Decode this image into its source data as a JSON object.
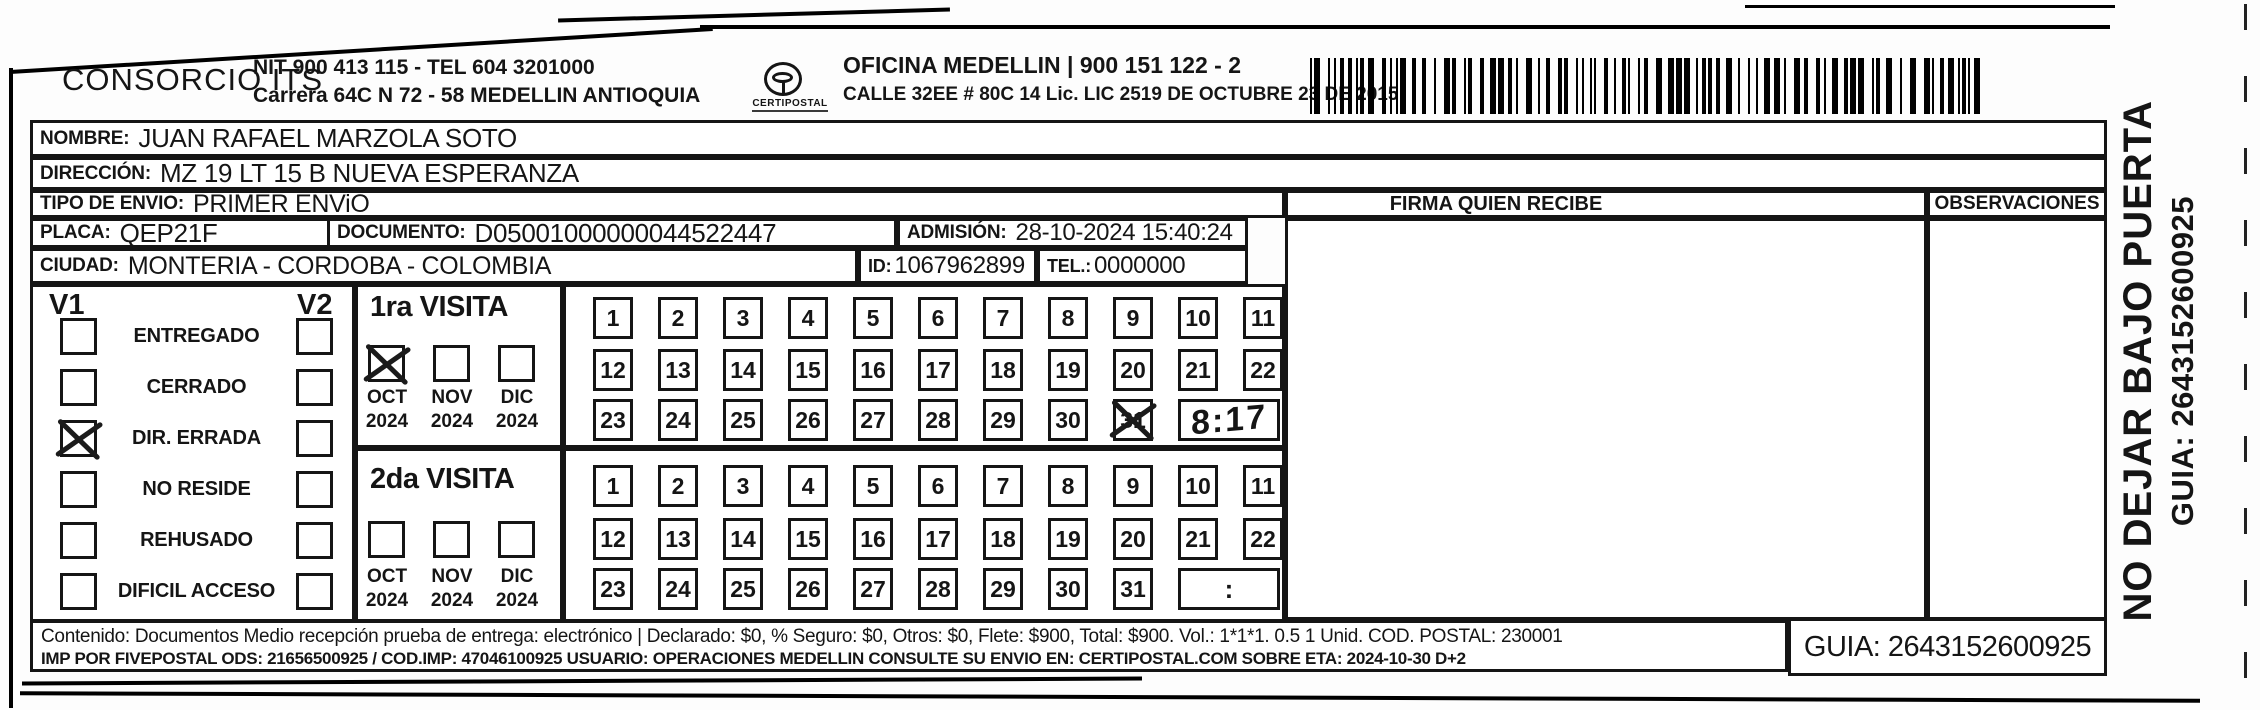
{
  "header": {
    "company": "CONSORCIO ITS",
    "nit_line": "NIT 900 413 115 - TEL 604 3201000",
    "address_line": "Carrera 64C N 72 - 58 MEDELLIN ANTIOQUIA",
    "logo_text": "CERTIPOSTAL",
    "office_line": "OFICINA MEDELLIN | 900 151 122 - 2",
    "office_address": "CALLE 32EE # 80C 14 Lic. LIC 2519 DE OCTUBRE 23 DE 2015"
  },
  "fields": {
    "nombre": {
      "label": "NOMBRE:",
      "value": "JUAN RAFAEL MARZOLA SOTO"
    },
    "direccion": {
      "label": "DIRECCIÓN:",
      "value": "MZ 19 LT 15 B NUEVA ESPERANZA"
    },
    "tipo": {
      "label": "TIPO DE ENVIO:",
      "value": "PRIMER ENViO"
    },
    "placa": {
      "label": "PLACA:",
      "value": "QEP21F"
    },
    "documento": {
      "label": "DOCUMENTO:",
      "value": "D05001000000044522447"
    },
    "admision": {
      "label": "ADMISIÓN:",
      "value": "28-10-2024 15:40:24"
    },
    "ciudad": {
      "label": "CIUDAD:",
      "value": "MONTERIA - CORDOBA - COLOMBIA"
    },
    "id": {
      "label": "ID:",
      "value": "1067962899"
    },
    "tel": {
      "label": "TEL.:",
      "value": "0000000"
    }
  },
  "signature_columns": {
    "firma_label": "FIRMA QUIEN RECIBE",
    "observaciones_label": "OBSERVACIONES"
  },
  "status_panel": {
    "v1_label": "V1",
    "v2_label": "V2",
    "options": [
      {
        "label": "ENTREGADO",
        "v1": false,
        "v2": false
      },
      {
        "label": "CERRADO",
        "v1": false,
        "v2": false
      },
      {
        "label": "DIR. ERRADA",
        "v1": true,
        "v2": false
      },
      {
        "label": "NO RESIDE",
        "v1": false,
        "v2": false
      },
      {
        "label": "REHUSADO",
        "v1": false,
        "v2": false
      },
      {
        "label": "DIFICIL ACCESO",
        "v1": false,
        "v2": false
      }
    ]
  },
  "visits": [
    {
      "title": "1ra VISITA",
      "months": [
        {
          "label": "OCT",
          "year": "2024",
          "checked": true
        },
        {
          "label": "NOV",
          "year": "2024",
          "checked": false
        },
        {
          "label": "DIC",
          "year": "2024",
          "checked": false
        }
      ],
      "days": [
        1,
        2,
        3,
        4,
        5,
        6,
        7,
        8,
        9,
        10,
        11,
        12,
        13,
        14,
        15,
        16,
        17,
        18,
        19,
        20,
        21,
        22,
        23,
        24,
        25,
        26,
        27,
        28,
        29,
        30,
        31
      ],
      "crossed_day": 31,
      "time_value": "8:17",
      "time_handwritten": true
    },
    {
      "title": "2da VISITA",
      "months": [
        {
          "label": "OCT",
          "year": "2024",
          "checked": false
        },
        {
          "label": "NOV",
          "year": "2024",
          "checked": false
        },
        {
          "label": "DIC",
          "year": "2024",
          "checked": false
        }
      ],
      "days": [
        1,
        2,
        3,
        4,
        5,
        6,
        7,
        8,
        9,
        10,
        11,
        12,
        13,
        14,
        15,
        16,
        17,
        18,
        19,
        20,
        21,
        22,
        23,
        24,
        25,
        26,
        27,
        28,
        29,
        30,
        31
      ],
      "crossed_day": null,
      "time_value": ":",
      "time_handwritten": false
    }
  ],
  "footer": {
    "line1": "Contenido: Documentos Medio recepción prueba de entrega: electrónico | Declarado: $0, % Seguro: $0, Otros: $0, Flete: $900, Total: $900. Vol.: 1*1*1. 0.5  1 Unid. COD. POSTAL: 230001",
    "line2": "IMP POR FIVEPOSTAL ODS: 21656500925 / COD.IMP: 47046100925 USUARIO: OPERACIONES MEDELLIN CONSULTE SU ENVIO EN: CERTIPOSTAL.COM SOBRE ETA: 2024-10-30 D+2",
    "guia_box": "GUIA: 2643152600925"
  },
  "side_note": {
    "warning": "NO DEJAR BAJO PUERTA",
    "guia": "GUIA: 2643152600925"
  },
  "ink_color": "#151515"
}
